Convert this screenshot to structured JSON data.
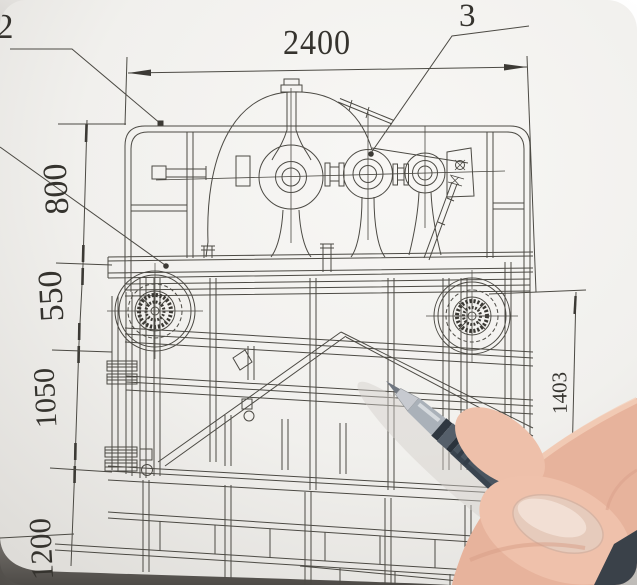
{
  "scene": {
    "description": "Photograph of a hand holding a gray gel pen pointing at a mechanical assembly engineering drawing",
    "paper_color": "#f1f0ed",
    "line_color": "#4c4a44",
    "pen_color": "#4a5560",
    "skin_color": "#e7b39c",
    "table_color": "#55524d"
  },
  "drawing": {
    "callouts": [
      {
        "label": "2"
      },
      {
        "label": "3"
      }
    ],
    "dimensions": {
      "top_width": "2400",
      "left_heights": [
        "800",
        "550",
        "1050",
        "1200"
      ],
      "right_height": "1403"
    }
  }
}
